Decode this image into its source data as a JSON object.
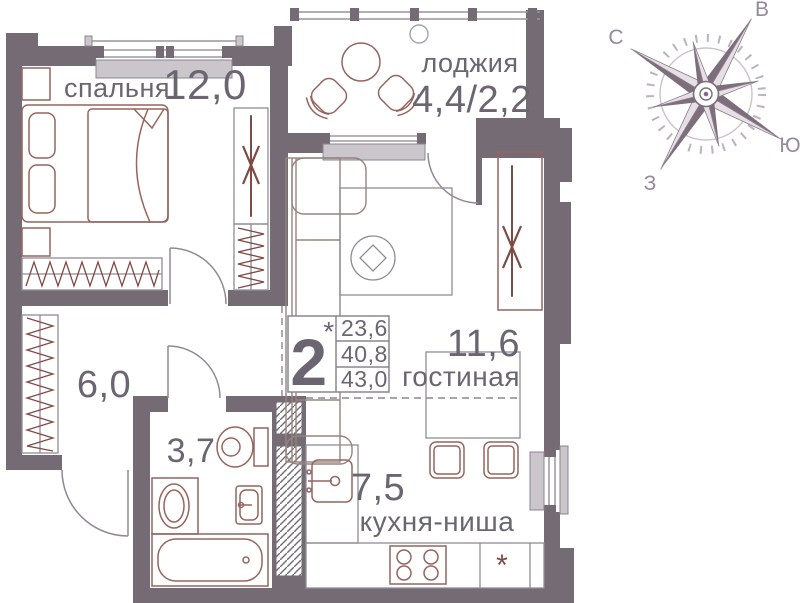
{
  "plan": {
    "rooms": {
      "bedroom": {
        "name": "спальня",
        "area": "12,0"
      },
      "loggia": {
        "name": "лоджия",
        "area": "4,4/2,2"
      },
      "living": {
        "name": "гостиная",
        "area": "11,6"
      },
      "kitchen": {
        "name": "кухня-ниша",
        "area": "7,5"
      },
      "hall": {
        "area": "6,0"
      },
      "bathroom": {
        "area": "3,7"
      }
    },
    "info_box": {
      "rooms_count": "2",
      "footnote_mark": "*",
      "rows": [
        "23,6",
        "40,8",
        "43,0"
      ]
    }
  },
  "compass": {
    "north": "С",
    "east": "В",
    "south": "Ю",
    "west": "З"
  },
  "symbols": {
    "fridge_mark": "*"
  },
  "colors": {
    "wall": "#756b75",
    "furn": "#96655e",
    "accent": "#7e4a44",
    "text": "#6b6572",
    "light": "#cac6cb",
    "line": "#8a8590",
    "sofa": "#97837d",
    "gray": "#908c95"
  }
}
